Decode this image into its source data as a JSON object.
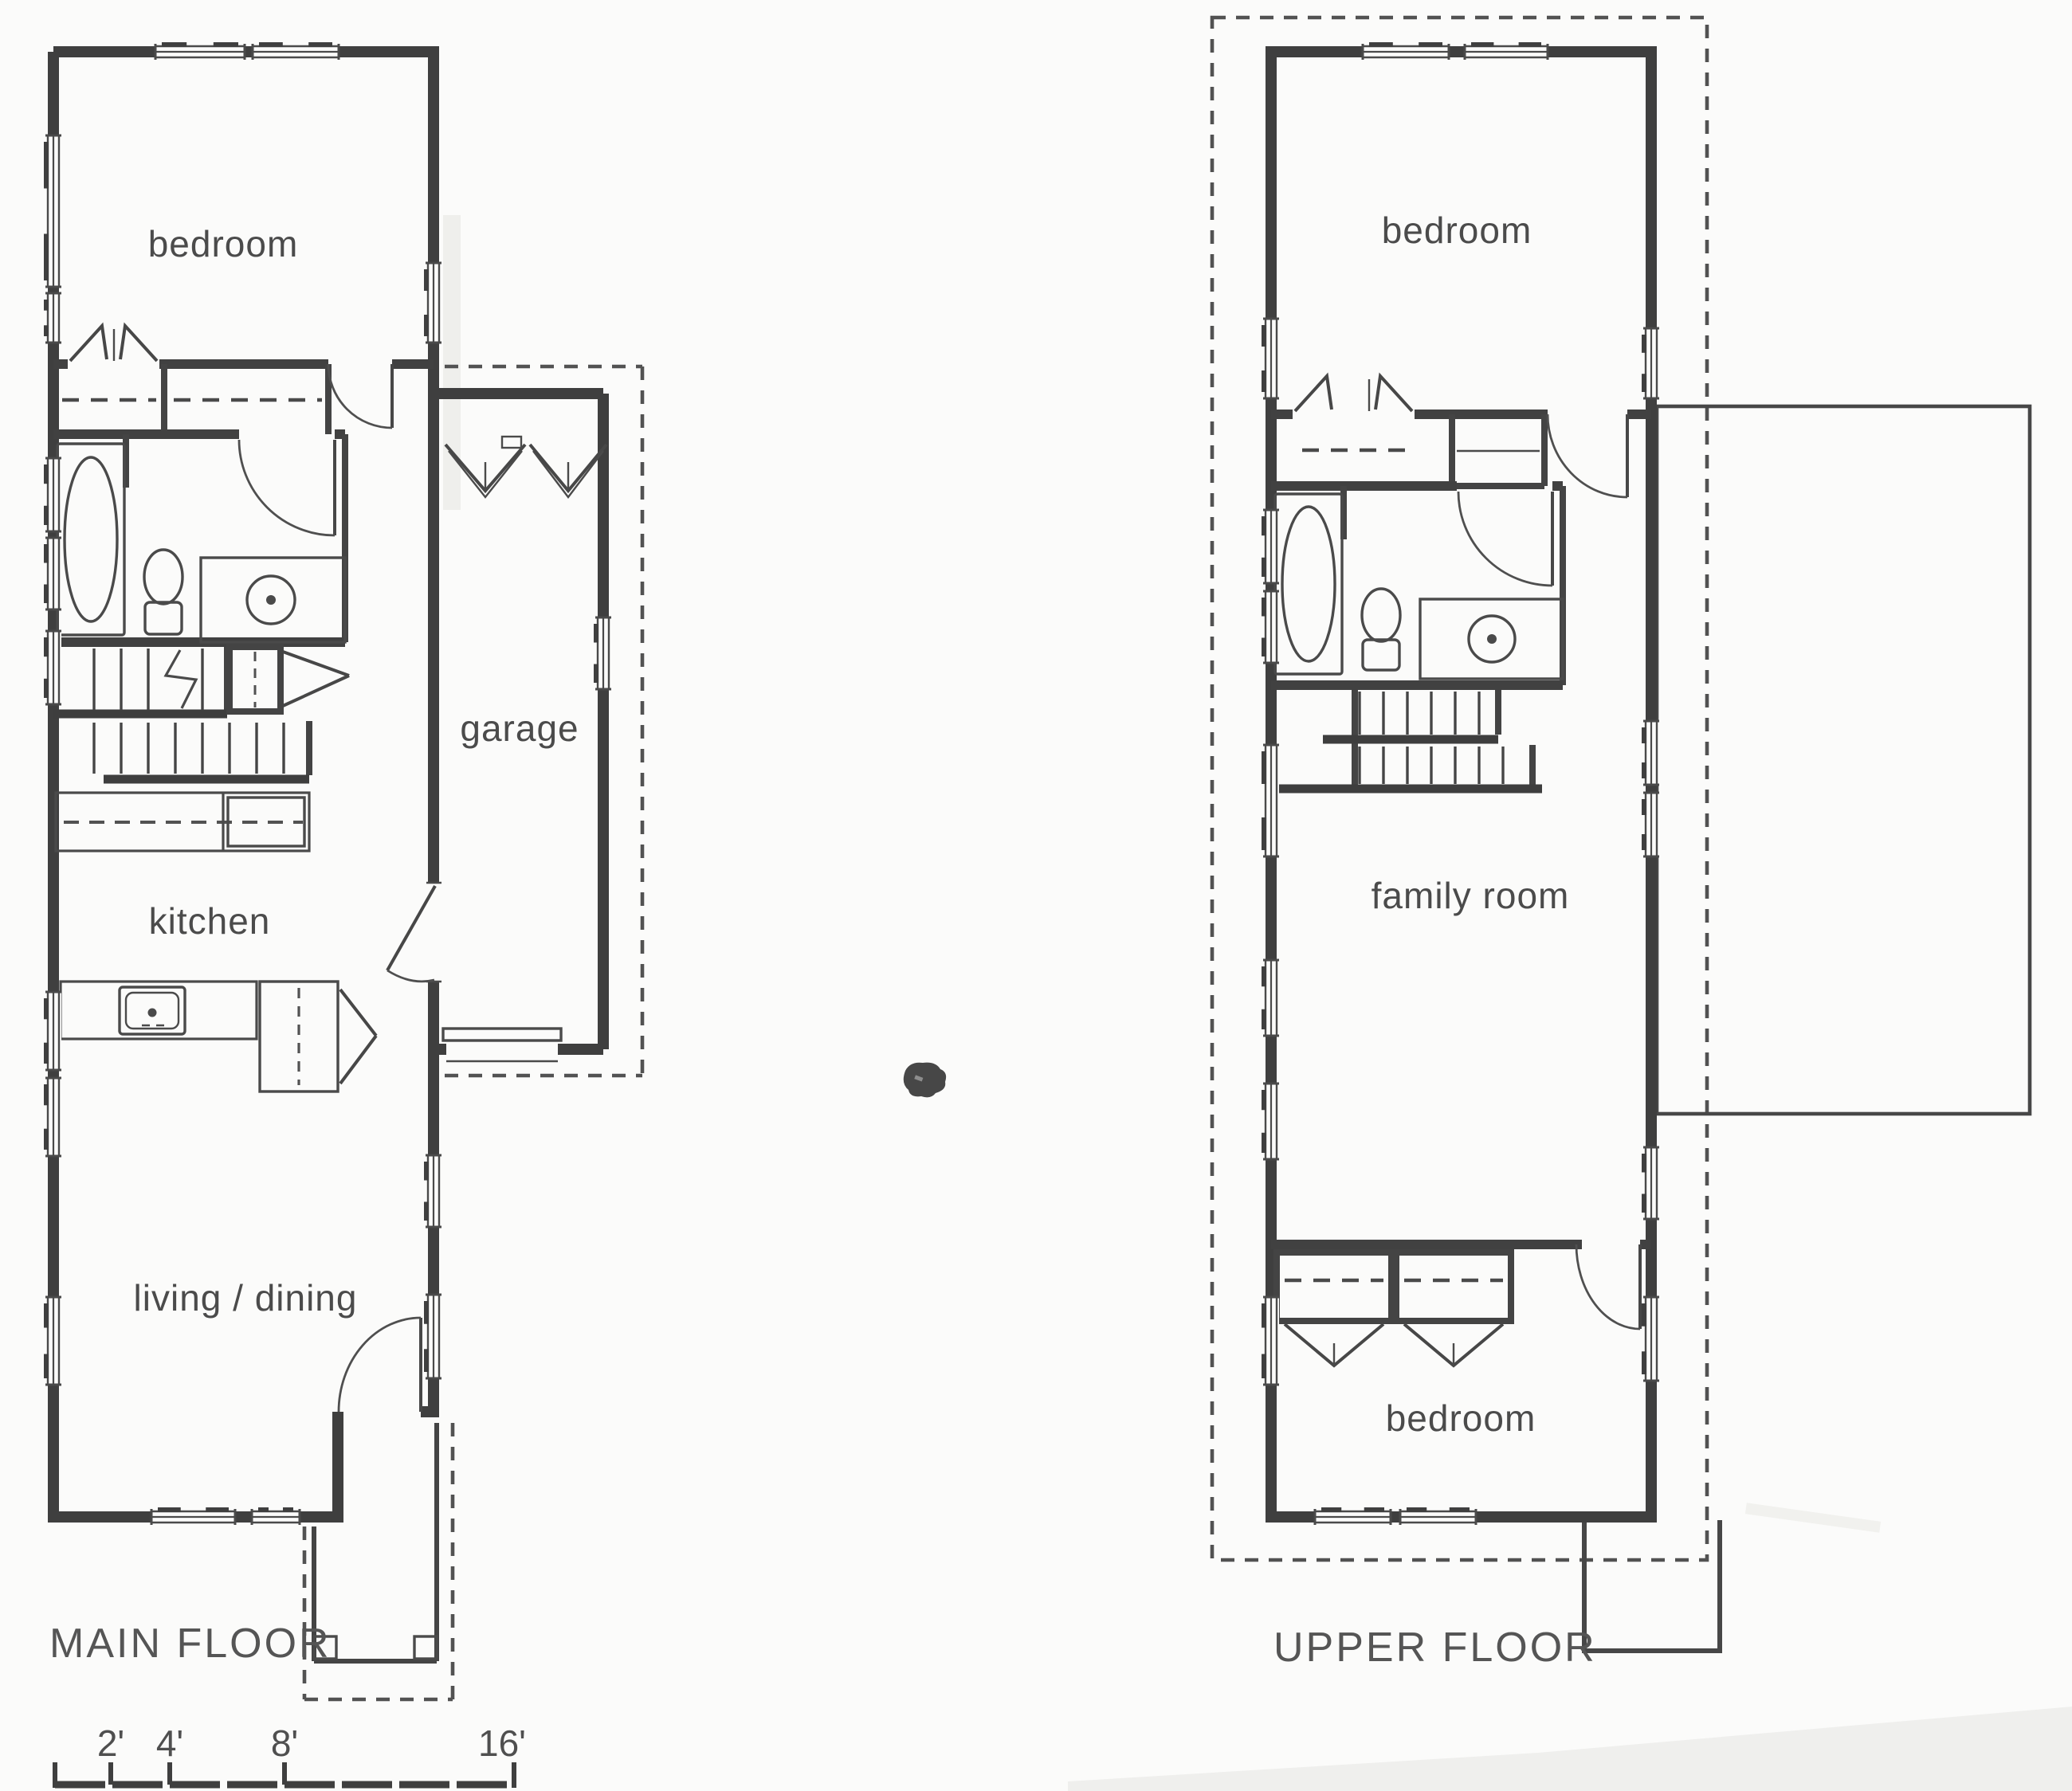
{
  "sheet": {
    "description": "scanned architectural floor plan, two plans side by side",
    "colors": {
      "line": "#3f3f3f",
      "text": "#4b4b4b",
      "paper": "#fbfbfa"
    }
  },
  "main_floor": {
    "title": "MAIN FLOOR",
    "bedroom_label": "bedroom",
    "kitchen_label": "kitchen",
    "living_label": "living / dining",
    "garage_label": "garage"
  },
  "upper_floor": {
    "title": "UPPER FLOOR",
    "bedroom_top_label": "bedroom",
    "family_label": "family room",
    "bedroom_bottom_label": "bedroom"
  },
  "scale_bar": {
    "tick_labels": [
      "2'",
      "4'",
      "8'",
      "16'"
    ]
  }
}
